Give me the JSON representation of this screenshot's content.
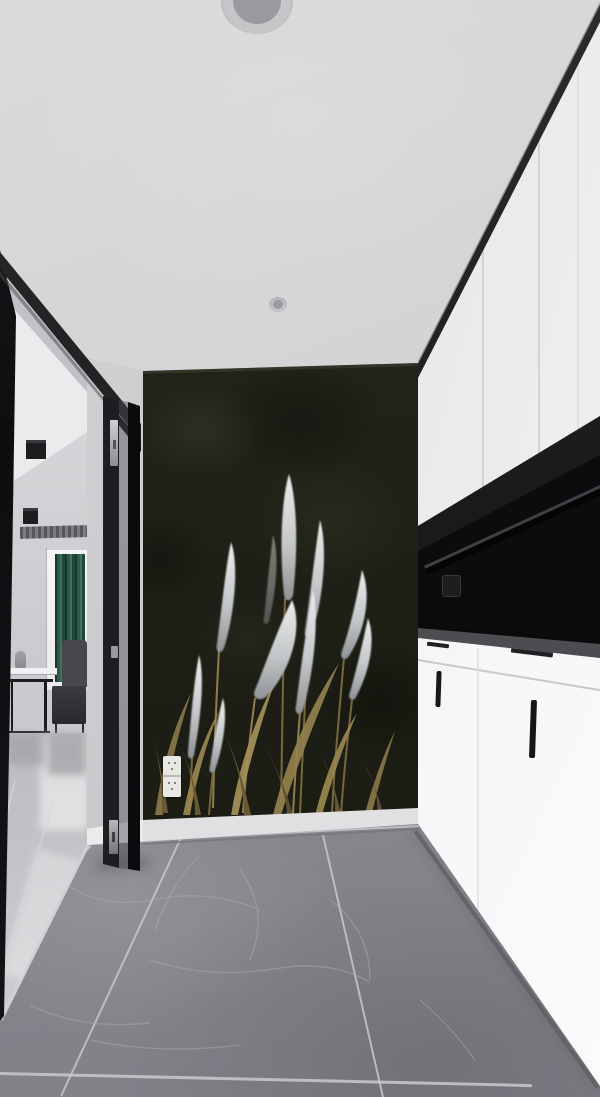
{
  "scene": {
    "label": "Hallway interior photograph",
    "regions": {
      "ceiling": "white ceiling with recessed downlights",
      "doorway": "open black-framed glass door to living room",
      "accent_wall": "dark textured accent wall with pampas grass mural",
      "cabinets": "white high-gloss cabinet wall with black open niche",
      "hall_floor": "large-format grey marble floor tiles",
      "room": "living room with green curtain, window and metal furniture"
    },
    "palette": {
      "ceiling": "#d3d3d5",
      "accent_wall": "#21231a",
      "mural_plume": "#cfd2d4",
      "mural_stem": "#8a7847",
      "cabinet_white": "#f0f0f3",
      "trim_black": "#121214",
      "niche_black": "#0c0c0e",
      "curtain_green": "#2c5a4c",
      "hall_floor": "#8b8b90",
      "room_floor": "#c2c2c6",
      "baseboard": "#ececec",
      "grout": "#c6c6ca",
      "metal_hardware": "#b0b0b4"
    },
    "objects": [
      "recessed-downlight",
      "small-spotlight",
      "door-frame",
      "folding-glass-door",
      "door-lock-plate",
      "cube-ceiling-light",
      "ac-linear-vent",
      "window",
      "green-curtain",
      "armchair",
      "ottoman",
      "metal-frame-table",
      "vase",
      "pampas-grass-mural",
      "wall-outlet",
      "baseboard",
      "upper-cabinets",
      "open-niche-shelf",
      "countertop",
      "lower-cabinets",
      "cabinet-handle",
      "marble-tile-floor"
    ]
  }
}
